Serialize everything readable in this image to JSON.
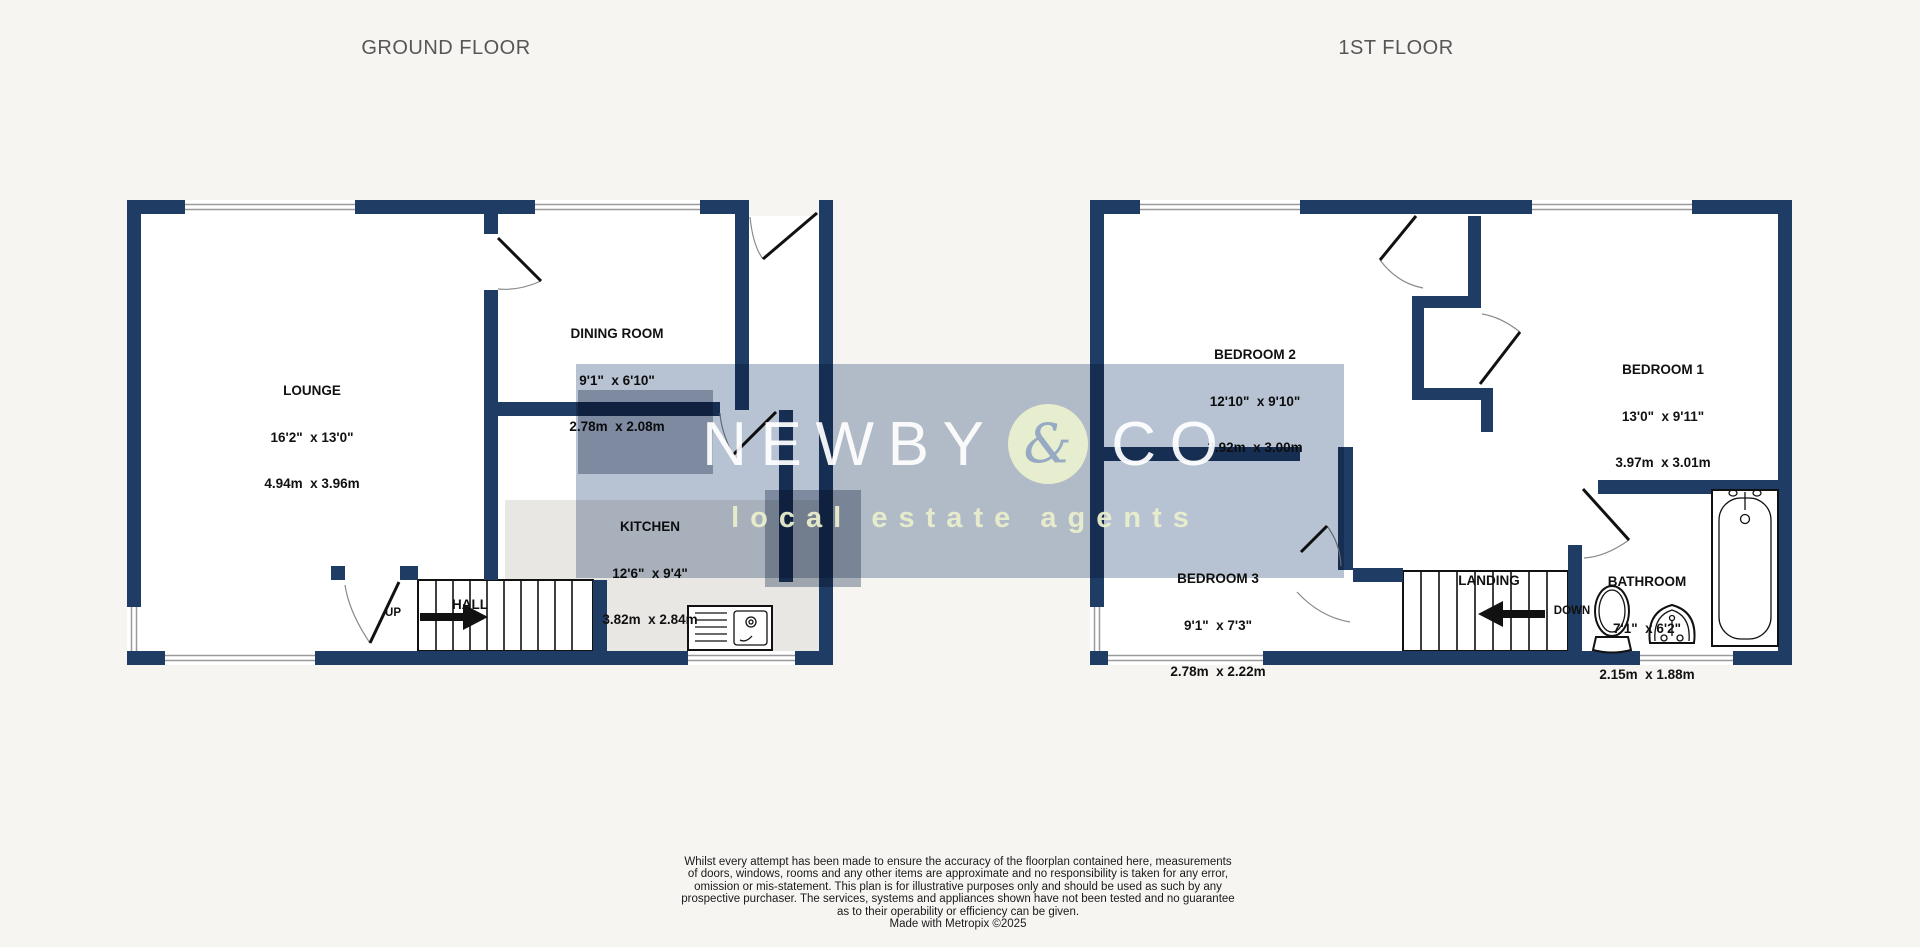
{
  "titles": {
    "ground": "GROUND FLOOR",
    "first": "1ST FLOOR"
  },
  "rooms": {
    "lounge": {
      "name": "LOUNGE",
      "imperial": "16'2\"  x 13'0\"",
      "metric": "4.94m  x 3.96m"
    },
    "dining": {
      "name": "DINING ROOM",
      "imperial": "9'1\"  x 6'10\"",
      "metric": "2.78m  x 2.08m"
    },
    "kitchen": {
      "name": "KITCHEN",
      "imperial": "12'6\"  x 9'4\"",
      "metric": "3.82m  x 2.84m"
    },
    "hall": {
      "name": "HALL"
    },
    "bedroom2": {
      "name": "BEDROOM 2",
      "imperial": "12'10\"  x 9'10\"",
      "metric": "3.92m  x 3.00m"
    },
    "bedroom1": {
      "name": "BEDROOM 1",
      "imperial": "13'0\"  x 9'11\"",
      "metric": "3.97m  x 3.01m"
    },
    "bedroom3": {
      "name": "BEDROOM 3",
      "imperial": "9'1\"  x 7'3\"",
      "metric": "2.78m  x 2.22m"
    },
    "bathroom": {
      "name": "BATHROOM",
      "imperial": "7'1\"  x 6'2\"",
      "metric": "2.15m  x 1.88m"
    },
    "landing": {
      "name": "LANDING"
    }
  },
  "stairs": {
    "up_label": "UP",
    "down_label": "DOWN"
  },
  "watermark": {
    "word_left": "NEWBY",
    "ampersand": "&",
    "word_right": "CO",
    "tagline": "local estate agents"
  },
  "disclaimer": {
    "lines": [
      "Whilst every attempt has been made to ensure the accuracy of the floorplan contained here, measurements",
      "of doors, windows, rooms and any other items are approximate and no responsibility is taken for any error,",
      "omission or mis-statement. This plan is for illustrative purposes only and should be used as such by any",
      "prospective purchaser. The services, systems and appliances shown have not been tested and no guarantee",
      "as to their operability or efficiency can be given.",
      "Made with Metropix ©2025"
    ]
  },
  "colors": {
    "wall_navy": "#1f3c64",
    "watermark_band": "#b7c2d2",
    "watermark_tagline": "#e9eecb",
    "background": "#f7f5f2"
  }
}
